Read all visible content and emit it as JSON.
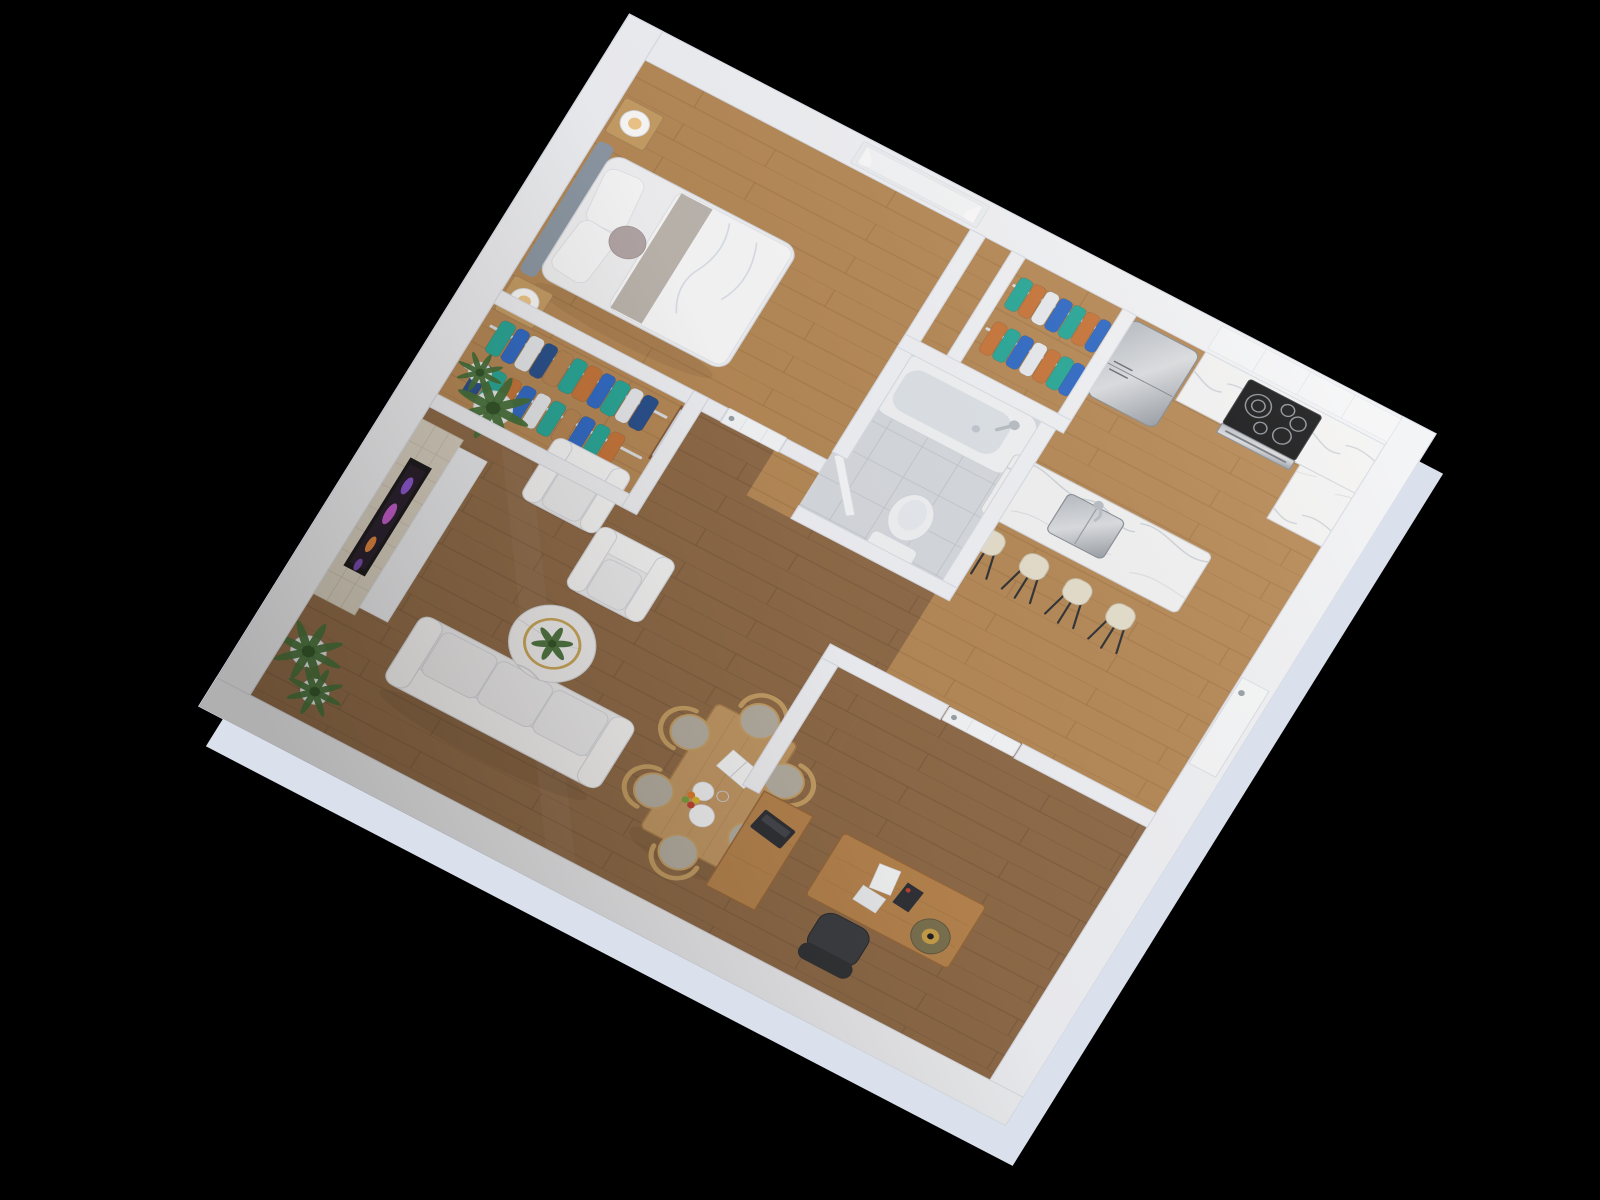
{
  "scene": {
    "description": "3D isometric render of a one-bedroom apartment floor plan on a black background",
    "background": "#000000",
    "rooms": [
      {
        "id": "bedroom",
        "name": "bedroom"
      },
      {
        "id": "bedroom-closet",
        "name": "walk-through closet"
      },
      {
        "id": "hall-closet",
        "name": "hall closet"
      },
      {
        "id": "bathroom",
        "name": "bathroom"
      },
      {
        "id": "kitchen",
        "name": "kitchen"
      },
      {
        "id": "living-room",
        "name": "living room"
      },
      {
        "id": "dining-area",
        "name": "dining area"
      },
      {
        "id": "office",
        "name": "office / second bedroom"
      }
    ],
    "furniture": [
      "bed",
      "tufted-headboard",
      "nightstands",
      "table-lamps",
      "hanging-clothes",
      "framed-mirror",
      "window-with-curtains",
      "bathtub",
      "toilet",
      "refrigerator",
      "range-cooktop",
      "oven",
      "kitchen-cabinets",
      "kitchen-island",
      "island-sink",
      "bar-stools",
      "electric-fireplace",
      "potted-palms",
      "armchairs",
      "sofa",
      "marble-coffee-table",
      "dining-table",
      "wishbone-chairs",
      "dinnerware",
      "open-book",
      "fruit",
      "desk",
      "desk-lamp",
      "papers",
      "office-chair",
      "bookcase",
      "laptop",
      "interior-doors",
      "entry-door"
    ],
    "counts": {
      "bar_stools": 4,
      "dining_chairs": 6,
      "armchairs": 2,
      "sofa_cushions": 3,
      "potted_plants": 4,
      "closet_rows": 4,
      "bedside_lamps": 2,
      "cooktop_burners": 5
    }
  },
  "colors": {
    "wall": "#f2f4f9",
    "wall_edge": "#dadfe9",
    "wall_base": "#dbe1ec",
    "door": "#f7f9fc",
    "handle": "#98a1ab",
    "window_recess": "#eef1f6",
    "wood_light": "#b78a58",
    "wood_light_line": "#9b7244",
    "wood_dark": "#8f6b49",
    "wood_dark_line": "#74563a",
    "tile": "#d8dce2",
    "tile_line": "#c5cad2",
    "marble": "#f4f5f7",
    "marble_vein": "#b3bac6",
    "fixture": "#f3f5f9",
    "fixture_edge": "#d6dbe3",
    "tub_basin": "#dfe5ec",
    "chrome": "#b9c0c9",
    "headboard": "#8d9aa8",
    "bedding": "#f4f5f8",
    "bedding_hi": "#fbfcfe",
    "blanket": "#b3aca4",
    "accent_pillow": "#b5a8aa",
    "wood_furn": "#c79e66",
    "lamp_warm": "#f2c98c",
    "rod": "#dde1e7",
    "cloth_teal": "#27a99b",
    "cloth_blue": "#2f6bc9",
    "cloth_navy": "#27508f",
    "cloth_orange": "#c8763b",
    "cloth_tan": "#b98755",
    "cloth_white": "#e9ecf1",
    "mirror_wood": "#8a5a38",
    "steel_a": "#b7bdc5",
    "steel_b": "#dcdfe4",
    "steel_c": "#969da6",
    "island": "#eef0f4",
    "stool": "#e7e1d0",
    "stool_leg": "#2e3135",
    "cooktop": "#17181c",
    "burner": "#8e949c",
    "stone": "#d9d3c5",
    "stone_line": "#c2bba8",
    "firebox": "#17161a",
    "flame_a": "#8a55d6",
    "flame_b": "#c45ad0",
    "flame_c": "#e0853f",
    "hearth": "#edf0f5",
    "sofa": "#f1f2f5",
    "sofa_edge": "#d8dce4",
    "sofa_hi": "#fafbfd",
    "gold": "#c9a24a",
    "leaf": "#44703a",
    "leaf_dark": "#2f5429",
    "pot": "#eceff3",
    "table_wood": "#c49a67",
    "table_wood_line": "#a87e4d",
    "chair_wood": "#c7a167",
    "chair_seat": "#b7b1a6",
    "paper": "#f8fafc",
    "desk_wood": "#b8854f",
    "desk_wood_line": "#97693c",
    "laptop": "#2c2f35",
    "laptop_key": "#42464e",
    "chair_dark": "#3a3d43",
    "chair_dark_back": "#2e3136",
    "caster": "#5a5e64",
    "lamp_olive": "#7c7352",
    "fruit_orange": "#dd7b2e",
    "fruit_red": "#c04232",
    "fruit_green": "#79a03f",
    "fruit_yellow": "#ddb52f",
    "shade_a": "rgba(255,240,215,0.10)",
    "shade_b": "rgba(60,45,25,0.06)",
    "shade_c": "rgba(25,18,10,0.30)"
  }
}
